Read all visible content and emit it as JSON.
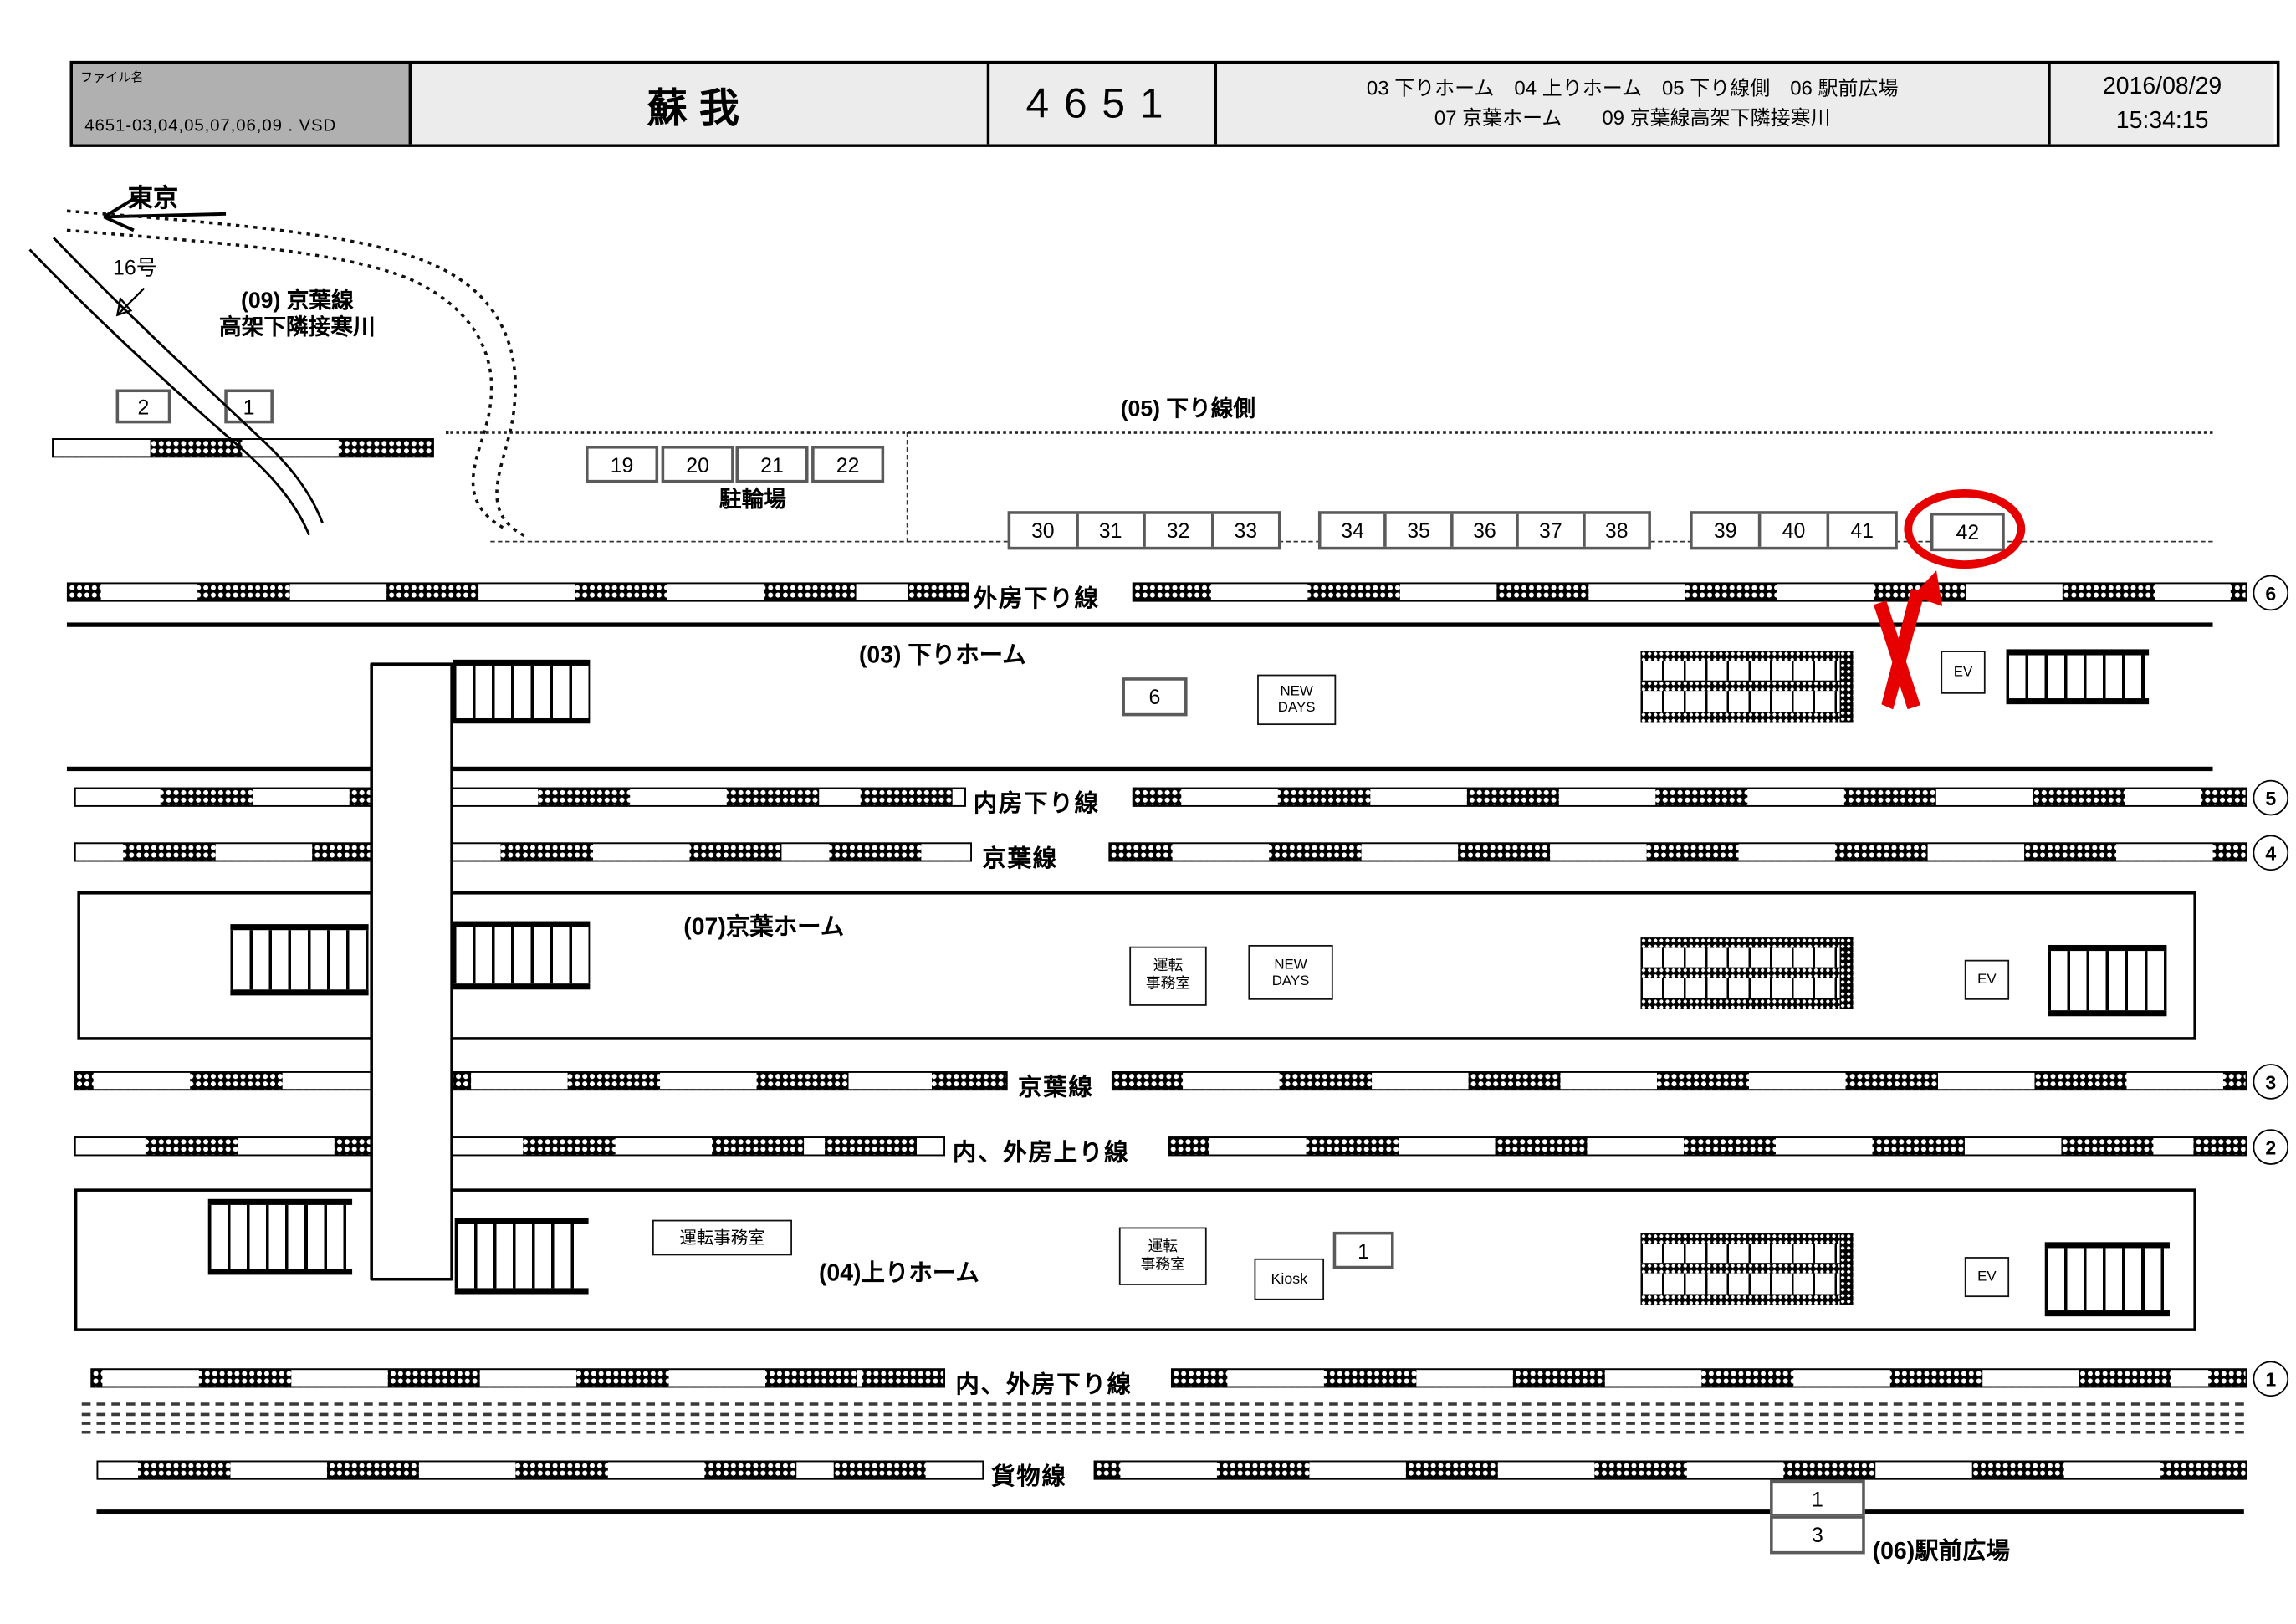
{
  "header": {
    "file_label": "ファイル名",
    "file_name": "4651-03,04,05,07,06,09 . VSD",
    "station_title": "蘇我",
    "drawing_number": "4651",
    "legend_line1": "03 下りホーム　04 上りホーム　05 下り線側　06 駅前広場",
    "legend_line2": "07 京葉ホーム　　09 京葉線高架下隣接寒川",
    "date": "2016/08/29",
    "time": "15:34:15"
  },
  "map": {
    "direction_tokyo": "東京",
    "route16": "16号",
    "area09_line1": "(09) 京葉線",
    "area09_line2": "高架下隣接寒川",
    "area05_label": "(05) 下り線側",
    "bicycle_label": "駐輪場",
    "platform03_label": "(03) 下りホーム",
    "platform07_label": "(07)京葉ホーム",
    "platform04_label": "(04)上りホーム",
    "plaza06_label": "(06)駅前広場",
    "tracks": {
      "sotobo_down": "外房下り線",
      "uchibo_down": "内房下り線",
      "keiyo_a": "京葉線",
      "keiyo_b": "京葉線",
      "uchi_soto_up": "内、外房上り線",
      "uchi_soto_down": "内、外房下り線",
      "freight": "貨物線"
    },
    "track_circle_numbers": [
      "6",
      "5",
      "4",
      "3",
      "2",
      "1"
    ],
    "boxes": {
      "area09": [
        "2",
        "1"
      ],
      "bicycle": [
        "19",
        "20",
        "21",
        "22"
      ],
      "strip_a": [
        "30",
        "31",
        "32",
        "33"
      ],
      "strip_b": [
        "34",
        "35",
        "36",
        "37",
        "38"
      ],
      "strip_c": [
        "39",
        "40",
        "41"
      ],
      "highlighted": "42",
      "platform03": "6",
      "platform04": "1",
      "plaza": [
        "1",
        "3"
      ]
    },
    "facilities": {
      "newdays_line1": "NEW",
      "newdays_line2": "DAYS",
      "ev": "EV",
      "kiosk": "Kiosk",
      "office_line1": "運転",
      "office_line2": "事務室",
      "office_wide": "運転事務室"
    }
  },
  "annotation": {
    "highlighted_box": "42",
    "highlight_color": "#e60000"
  }
}
